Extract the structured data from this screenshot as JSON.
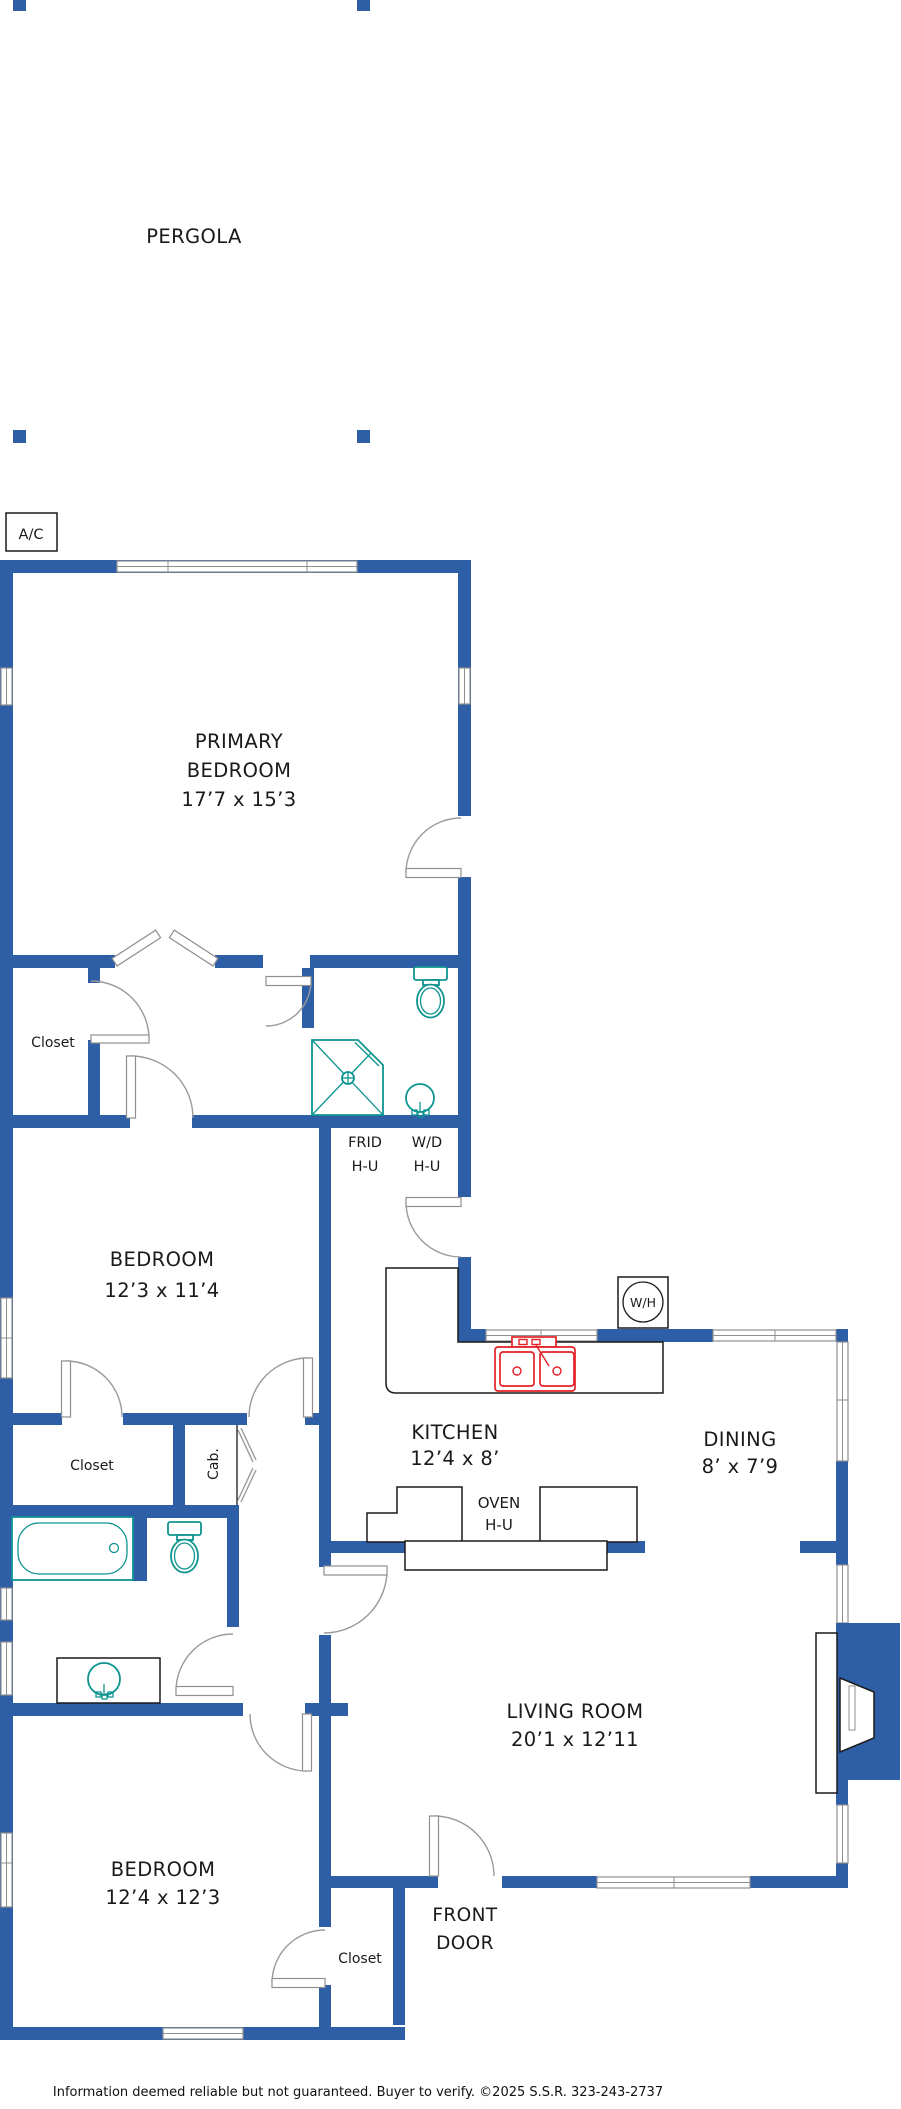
{
  "title": "Floor plan",
  "colors": {
    "wall_blue": "#2E5EA6",
    "fixture_teal": "#0E9490",
    "appliance_red": "#E42127",
    "outline_black": "#1A1A1A",
    "door_gray": "#9A9A9A"
  },
  "pergola": {
    "label": "PERGOLA"
  },
  "equipment": {
    "ac": "A/C",
    "water_heater": "W/H",
    "frid_line1": "FRID",
    "frid_line2": "H-U",
    "wd_line1": "W/D",
    "wd_line2": "H-U",
    "oven_line1": "OVEN",
    "oven_line2": "H-U"
  },
  "rooms": {
    "primary": {
      "lines": [
        "PRIMARY",
        "BEDROOM",
        "17’7 x 15’3"
      ]
    },
    "bedroom2": {
      "lines": [
        "BEDROOM",
        "12’3 x 11’4"
      ]
    },
    "kitchen": {
      "lines": [
        "KITCHEN",
        "12’4 x 8’"
      ]
    },
    "dining": {
      "lines": [
        "DINING",
        "8’ x 7’9"
      ]
    },
    "living": {
      "lines": [
        "LIVING ROOM",
        "20’1 x 12’11"
      ]
    },
    "bedroom3": {
      "lines": [
        "BEDROOM",
        "12’4 x 12’3"
      ]
    },
    "front_door": {
      "lines": [
        "FRONT",
        "DOOR"
      ]
    },
    "closet_hall": "Closet",
    "closet_mid": "Closet",
    "closet_entry": "Closet",
    "cabinet": "Cab."
  },
  "footer": {
    "disclaimer": "Information deemed reliable but not guaranteed. Buyer to verify. ©2025 S.S.R. 323-243-2737"
  }
}
